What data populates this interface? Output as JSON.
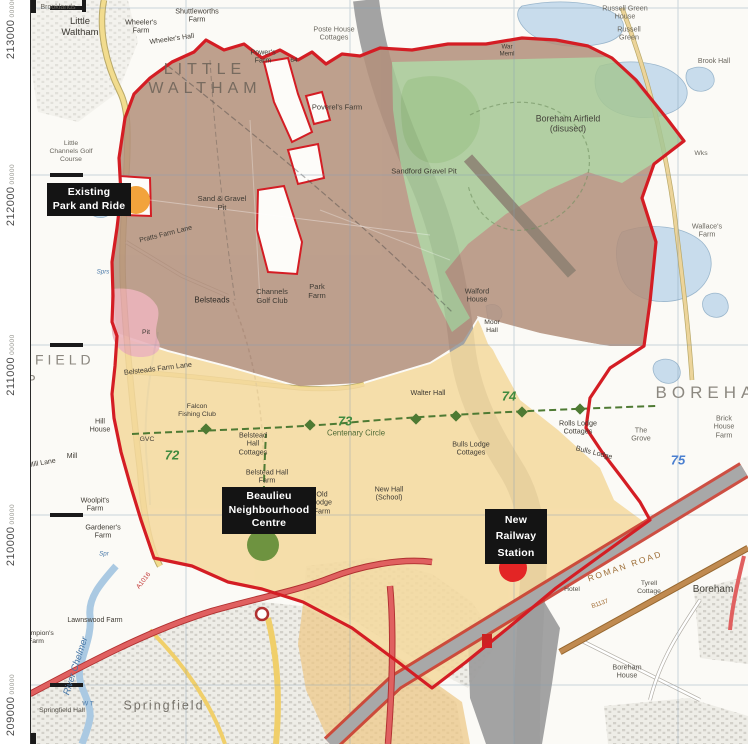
{
  "colors": {
    "boundary_red": "#d41d24",
    "zone_brown": "#b3907c",
    "zone_green": "#a6c795",
    "zone_yellow": "#f4d99e",
    "zone_ochre": "#edc987",
    "zone_pink": "#e8a8b2",
    "water": "#c8dcec",
    "lagoon": "#a3bddc",
    "corridor_grey": "#9e9e9e",
    "marker_orange": "#f2a33c",
    "marker_green": "#6e9340",
    "marker_red": "#e32525",
    "callout_bg": "#141414",
    "callout_text": "#ffffff",
    "grid_line": "#7f9cb5",
    "road_red": "#e06060",
    "road_yellow": "#f2dc8e",
    "roman_road": "#c08a50",
    "byway_green": "#4e7a33",
    "railway_red": "#c83c30",
    "urban_grey": "#c9c6bf"
  },
  "grid_labels": [
    {
      "text": "213000",
      "suffix": "00000",
      "y": 8
    },
    {
      "text": "212000",
      "suffix": "00000",
      "y": 175
    },
    {
      "text": "211000",
      "suffix": "00000",
      "y": 345
    },
    {
      "text": "210000",
      "suffix": "00000",
      "y": 515
    },
    {
      "text": "209000",
      "suffix": "00000",
      "y": 685
    }
  ],
  "callouts": [
    {
      "name": "existing-park-and-ride",
      "text": "Existing\nPark and Ride",
      "box": {
        "x": 47,
        "y": 183,
        "w": 76
      },
      "dot": {
        "x": 136,
        "y": 200,
        "r": 14,
        "color": "#f2a33c"
      },
      "spread": false
    },
    {
      "name": "beaulieu-neighbourhood-centre",
      "text": "Beaulieu\nNeighbourhood\nCentre",
      "box": {
        "x": 222,
        "y": 487,
        "w": 86
      },
      "dot": {
        "x": 263,
        "y": 545,
        "r": 16,
        "color": "#6e9340"
      },
      "spread": false
    },
    {
      "name": "new-railway-station",
      "text": "New\nRailway\nStation",
      "box": {
        "x": 485,
        "y": 509,
        "w": 54
      },
      "dot": {
        "x": 513,
        "y": 568,
        "r": 14,
        "color": "#e32525"
      },
      "spread": true
    }
  ],
  "map_labels": [
    {
      "t": "Brooklands",
      "x": 58,
      "y": 8,
      "s": 7,
      "c": "#6a675f"
    },
    {
      "t": "Little\nWaltham",
      "x": 80,
      "y": 27,
      "s": 9.5,
      "c": "#3c3933"
    },
    {
      "t": "Wheeler's\nFarm",
      "x": 141,
      "y": 27,
      "s": 7.2
    },
    {
      "t": "Shuttleworths\nFarm",
      "x": 197,
      "y": 16,
      "s": 7.2
    },
    {
      "t": "Wheeler's Hall",
      "x": 172,
      "y": 40,
      "s": 7,
      "r": -8
    },
    {
      "t": "Poste House\nCottages",
      "x": 334,
      "y": 34,
      "s": 7.2,
      "c": "#6a675f"
    },
    {
      "t": "Power's\nFarm",
      "x": 263,
      "y": 57,
      "s": 7.2
    },
    {
      "t": "64",
      "x": 294,
      "y": 61,
      "s": 6.5
    },
    {
      "t": "Poverel's Farm",
      "x": 337,
      "y": 108,
      "s": 7.5
    },
    {
      "t": "LITTLE\nWALTHAM",
      "x": 205,
      "y": 80,
      "s": 16,
      "c": "#6b6157",
      "ls": 5,
      "o": 0.85
    },
    {
      "t": "Russell Green\nHouse",
      "x": 625,
      "y": 13,
      "s": 7.2,
      "c": "#6a675f"
    },
    {
      "t": "Russell\nGreen",
      "x": 629,
      "y": 34,
      "s": 7.2,
      "c": "#6a675f"
    },
    {
      "t": "Brook Hall",
      "x": 714,
      "y": 62,
      "s": 7,
      "c": "#6a675f"
    },
    {
      "t": "War\nMeml",
      "x": 507,
      "y": 51,
      "s": 6.2
    },
    {
      "t": "Boreham Airfield\n(disused)",
      "x": 568,
      "y": 124,
      "s": 8.8,
      "c": "#44423a"
    },
    {
      "t": "Wks",
      "x": 701,
      "y": 154,
      "s": 6.8,
      "c": "#6a675f"
    },
    {
      "t": "Wallace's\nFarm",
      "x": 707,
      "y": 231,
      "s": 7.2,
      "c": "#6a675f"
    },
    {
      "t": "Sand & Gravel\nPit",
      "x": 222,
      "y": 204,
      "s": 7.5
    },
    {
      "t": "Sandford Gravel Pit",
      "x": 424,
      "y": 172,
      "s": 7.5
    },
    {
      "t": "Pratts Farm Lane",
      "x": 166,
      "y": 235,
      "s": 7,
      "r": -14
    },
    {
      "t": "Little\nChannels Golf\nCourse",
      "x": 71,
      "y": 152,
      "s": 6.8,
      "c": "#6a675f"
    },
    {
      "t": "Belsteads",
      "x": 212,
      "y": 300,
      "s": 8,
      "c": "#2f2c27"
    },
    {
      "t": "Channels\nGolf Club",
      "x": 272,
      "y": 297,
      "s": 7.5
    },
    {
      "t": "Park\nFarm",
      "x": 317,
      "y": 292,
      "s": 7.5
    },
    {
      "t": "Walford\nHouse",
      "x": 477,
      "y": 296,
      "s": 7.2
    },
    {
      "t": "Moor\nHall",
      "x": 492,
      "y": 327,
      "s": 6.8
    },
    {
      "t": "Pit",
      "x": 146,
      "y": 333,
      "s": 6.8
    },
    {
      "t": "Belsteads Farm Lane",
      "x": 158,
      "y": 369,
      "s": 7.2,
      "r": -7
    },
    {
      "t": "Hill\nHouse",
      "x": 100,
      "y": 426,
      "s": 7.2
    },
    {
      "t": "Mill",
      "x": 72,
      "y": 457,
      "s": 7
    },
    {
      "t": "Mill Lane",
      "x": 42,
      "y": 464,
      "s": 7,
      "r": -10
    },
    {
      "t": "Woolpit's\nFarm",
      "x": 95,
      "y": 505,
      "s": 7.2
    },
    {
      "t": "Gardener's\nFarm",
      "x": 103,
      "y": 532,
      "s": 7.2
    },
    {
      "t": "Sprs",
      "x": 103,
      "y": 272,
      "s": 6.2,
      "c": "#4878a8",
      "i": 1
    },
    {
      "t": "Spr",
      "x": 104,
      "y": 554,
      "s": 6.2,
      "c": "#4878a8",
      "i": 1
    },
    {
      "t": "GVC",
      "x": 147,
      "y": 440,
      "s": 6.8
    },
    {
      "t": "72",
      "x": 172,
      "y": 455,
      "s": 13,
      "c": "#3f8a3f",
      "i": 1,
      "w": 700
    },
    {
      "t": "73",
      "x": 345,
      "y": 421,
      "s": 13,
      "c": "#3f8a3f",
      "i": 1,
      "w": 700
    },
    {
      "t": "74",
      "x": 509,
      "y": 396,
      "s": 13,
      "c": "#3f8a3f",
      "i": 1,
      "w": 700
    },
    {
      "t": "75",
      "x": 678,
      "y": 460,
      "s": 13,
      "c": "#4a7fd0",
      "i": 1,
      "w": 700
    },
    {
      "t": "Falcon\nFishing Club",
      "x": 197,
      "y": 411,
      "s": 6.8
    },
    {
      "t": "Belstead\nHall\nCottages",
      "x": 253,
      "y": 444,
      "s": 7.2
    },
    {
      "t": "Belstead Hall\nFarm",
      "x": 267,
      "y": 477,
      "s": 7.2
    },
    {
      "t": "Centenary Circle",
      "x": 356,
      "y": 433,
      "s": 7.8,
      "c": "#4e6a35"
    },
    {
      "t": "Walter Hall",
      "x": 428,
      "y": 393,
      "s": 7.2
    },
    {
      "t": "Rolls Lodge\nCottages",
      "x": 578,
      "y": 428,
      "s": 7.2
    },
    {
      "t": "Bulls Lodge",
      "x": 594,
      "y": 453,
      "s": 7.2,
      "r": 14
    },
    {
      "t": "Bulls Lodge\nCottages",
      "x": 471,
      "y": 449,
      "s": 7.2
    },
    {
      "t": "New Hall\n(School)",
      "x": 389,
      "y": 494,
      "s": 7.2
    },
    {
      "t": "Old\nLodge\nFarm",
      "x": 322,
      "y": 503,
      "s": 7.2
    },
    {
      "t": "The\nGrove",
      "x": 641,
      "y": 435,
      "s": 7.2,
      "c": "#6a675f"
    },
    {
      "t": "Brick House\nFarm",
      "x": 724,
      "y": 427,
      "s": 7.2,
      "c": "#6a675f"
    },
    {
      "t": "BOREHAM",
      "x": 716,
      "y": 393,
      "s": 17,
      "c": "#8c8880",
      "ls": 5
    },
    {
      "t": "MFIELD",
      "x": 57,
      "y": 360,
      "s": 14,
      "c": "#8c8880",
      "ls": 4
    },
    {
      "t": "P",
      "x": 31,
      "y": 380,
      "s": 14,
      "c": "#8c8880"
    },
    {
      "t": "ROMAN ROAD",
      "x": 625,
      "y": 566,
      "s": 8.5,
      "c": "#9c6b33",
      "r": -19,
      "ls": 2
    },
    {
      "t": "B1137",
      "x": 600,
      "y": 604,
      "s": 6.2,
      "c": "#a06a30",
      "r": -19
    },
    {
      "t": "Tyrell\nCottage",
      "x": 649,
      "y": 588,
      "s": 6.8,
      "c": "#55524a"
    },
    {
      "t": "Hotel",
      "x": 572,
      "y": 590,
      "s": 6.8,
      "c": "#55524a"
    },
    {
      "t": "Boreham\nHouse",
      "x": 627,
      "y": 672,
      "s": 7.2,
      "c": "#55524a"
    },
    {
      "t": "Boreham",
      "x": 713,
      "y": 590,
      "s": 10,
      "c": "#44423a"
    },
    {
      "t": "Springfield",
      "x": 164,
      "y": 706,
      "s": 12.5,
      "c": "#76726a",
      "ls": 2
    },
    {
      "t": "River Chelmer",
      "x": 76,
      "y": 666,
      "s": 9.5,
      "c": "#4878a8",
      "i": 1,
      "r": -72
    },
    {
      "t": "Lawnswood Farm",
      "x": 95,
      "y": 621,
      "s": 7
    },
    {
      "t": "Springfield Hall",
      "x": 62,
      "y": 711,
      "s": 6.8,
      "c": "#55524a"
    },
    {
      "t": "Champion's\nFarm",
      "x": 36,
      "y": 638,
      "s": 6.8
    },
    {
      "t": "A1016",
      "x": 144,
      "y": 581,
      "s": 6.5,
      "c": "#c03030",
      "r": -52
    },
    {
      "t": "W T",
      "x": 88,
      "y": 704,
      "s": 6.2,
      "c": "#4878a8"
    }
  ]
}
